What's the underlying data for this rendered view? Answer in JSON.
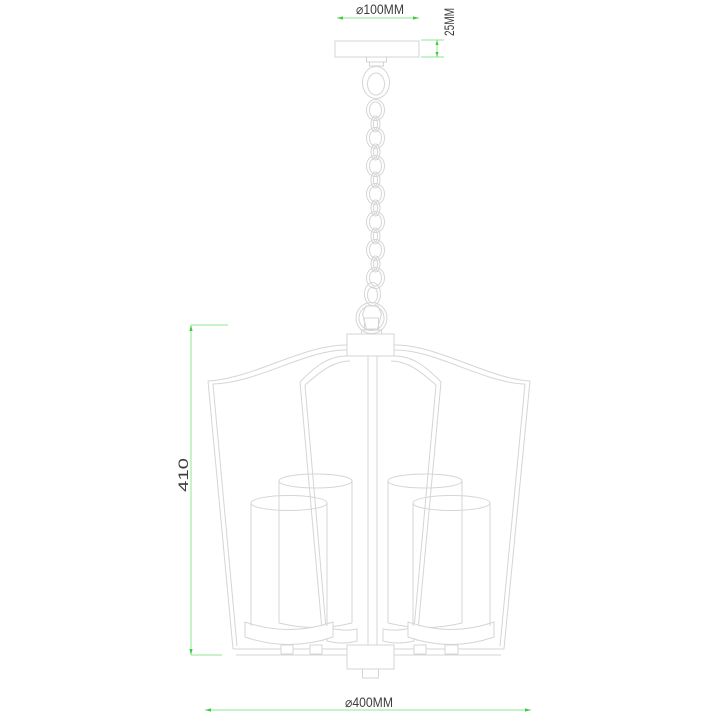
{
  "page": {
    "title": "Pendant chandelier dimensional line drawing",
    "background": "#ffffff"
  },
  "colors": {
    "background": "#ffffff",
    "drawing_line": "#d5d5d5",
    "dimension_line": "#90e690",
    "dimension_arrow": "#3ecb3e",
    "dimension_text": "#3d3d3d"
  },
  "dimensions": {
    "canopy_diameter": "⌀100MM",
    "canopy_height": "25MM",
    "body_height": "410",
    "body_width": "⌀400MM"
  },
  "drawing": {
    "subject": "4-light tapered lantern pendant chandelier with chain suspension",
    "parts": [
      "ceiling-canopy",
      "chain-collar",
      "hanging-shackle",
      "suspension-chain",
      "chain-finial",
      "hanging-loop-ring",
      "frame-hub",
      "cage-frame",
      "center-stem",
      "lamp-shades",
      "shade-holders",
      "bottom-plate"
    ]
  }
}
